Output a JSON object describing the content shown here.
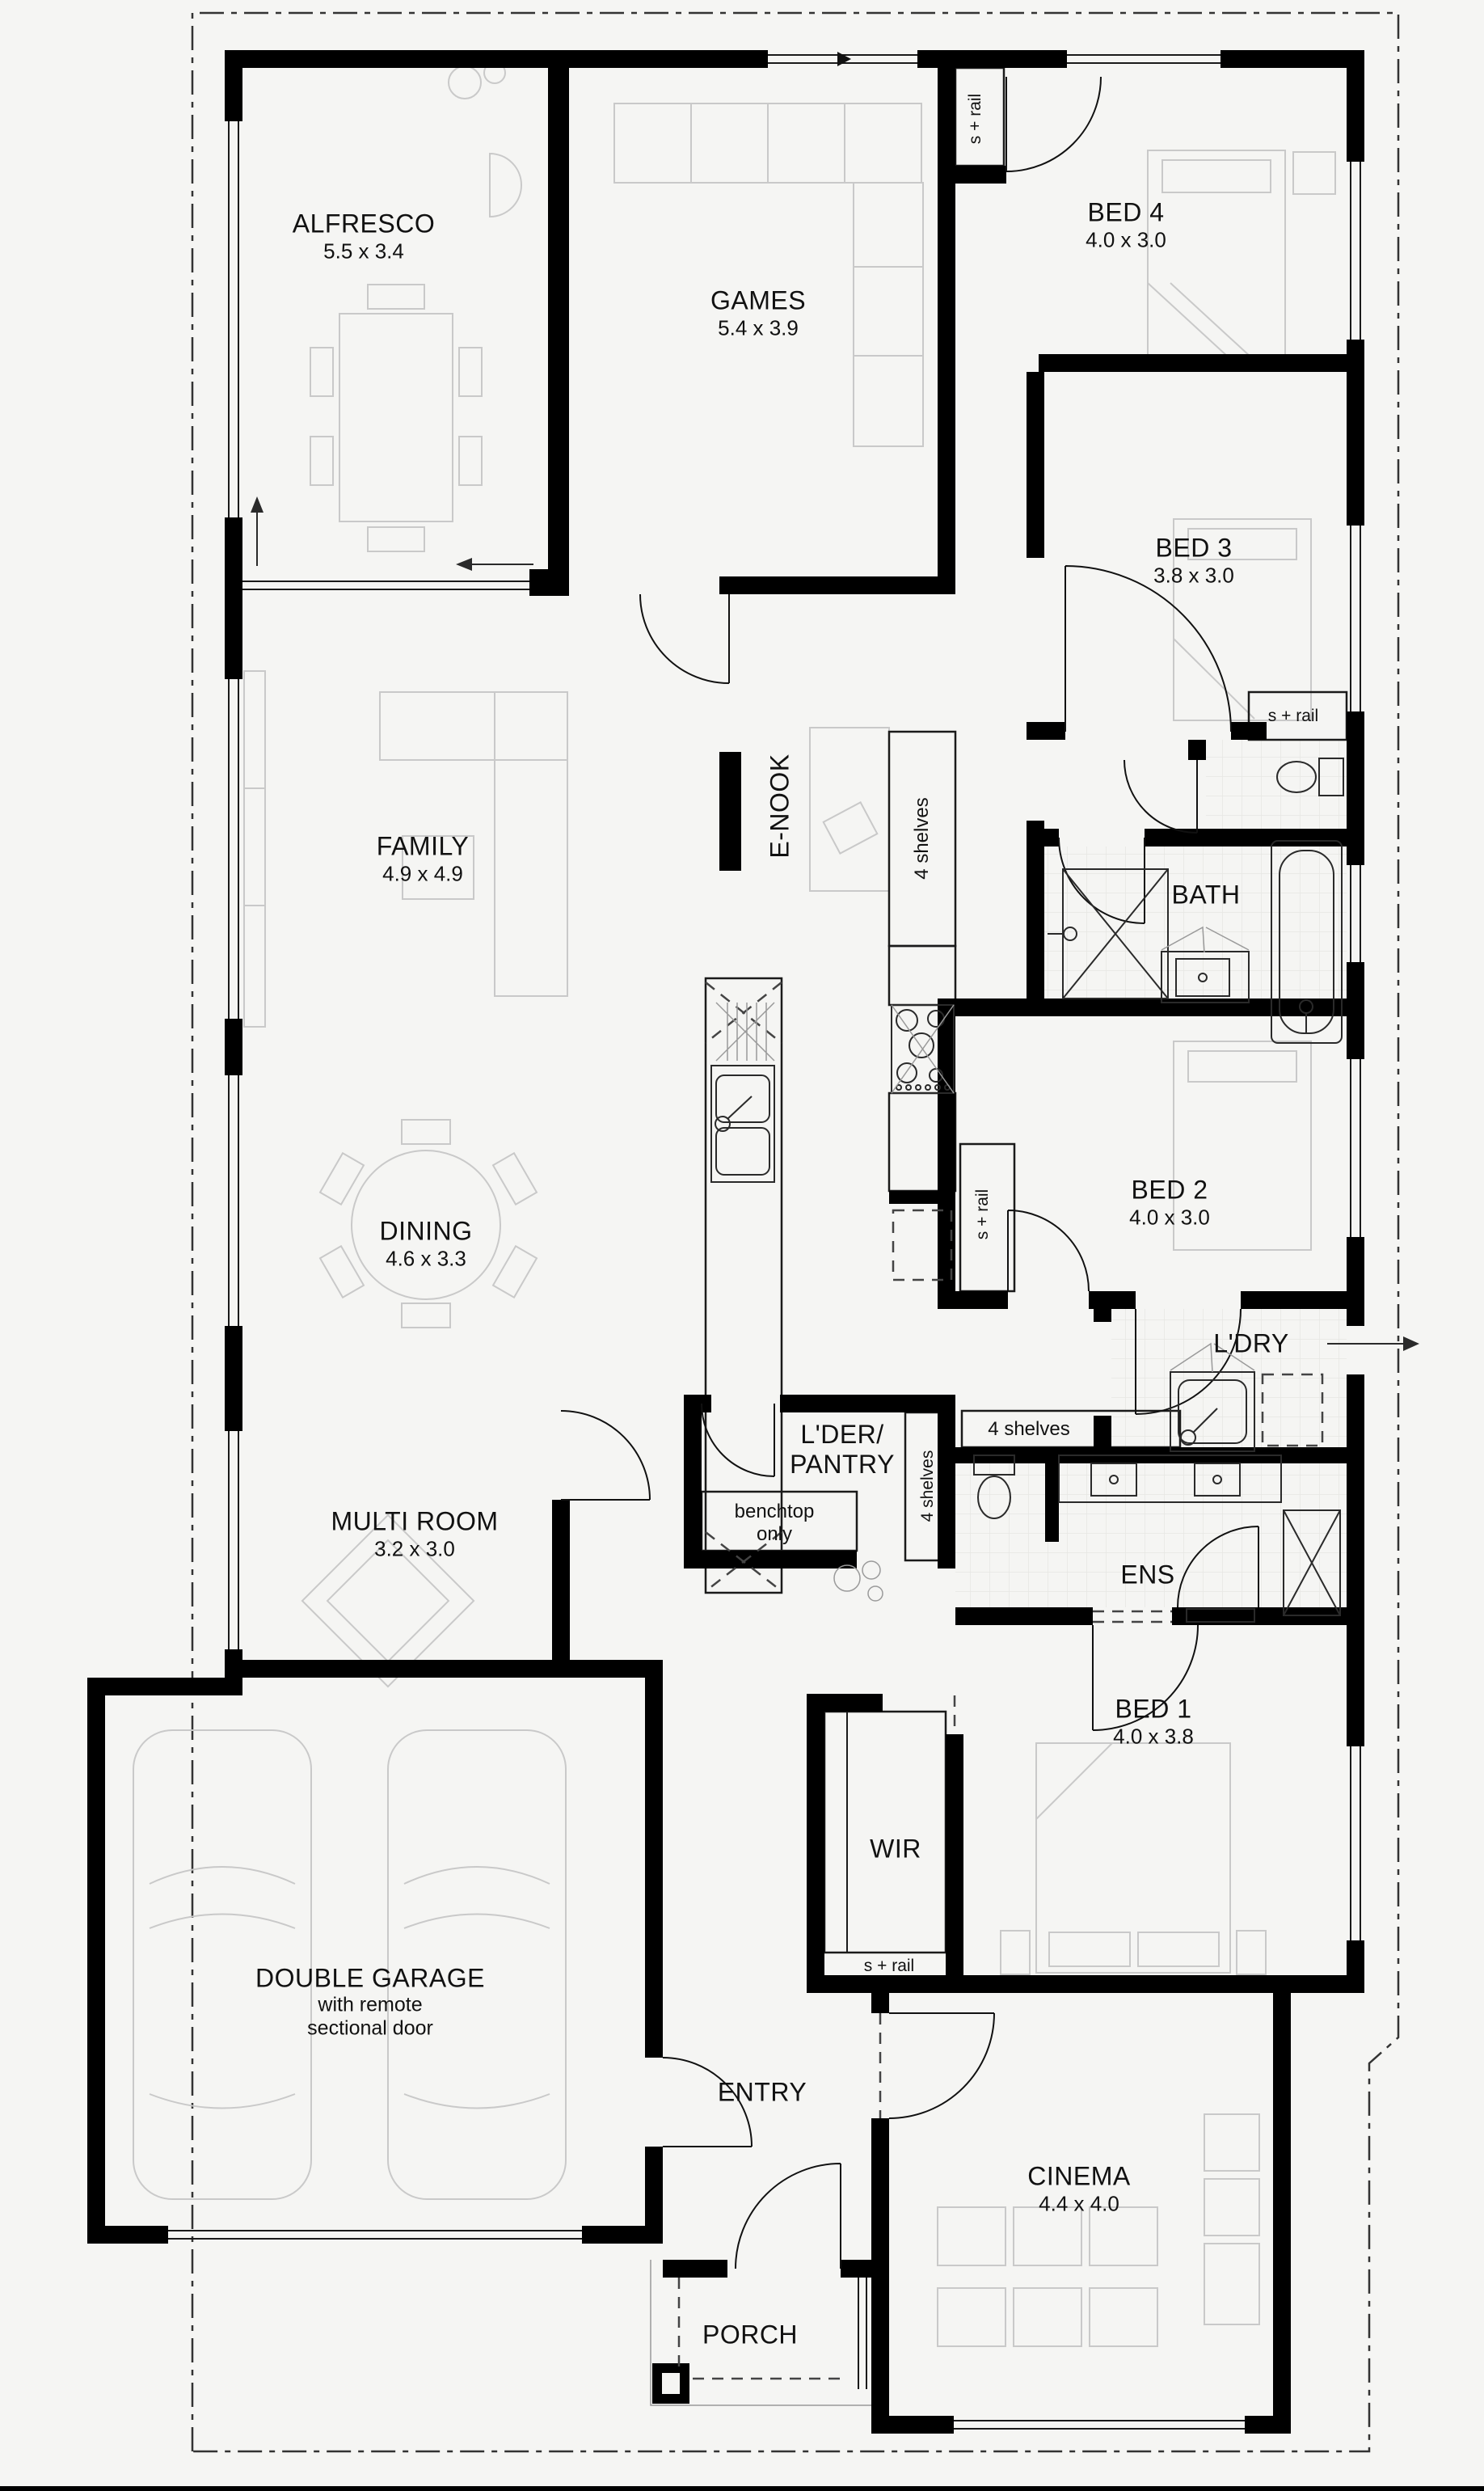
{
  "colors": {
    "background": "#f5f5f3",
    "wall": "#000000",
    "furniture_line": "#c9c9c9",
    "fixture_line": "#2a2a2a",
    "boundary_line": "#333333"
  },
  "rooms": {
    "alfresco": {
      "name": "ALFRESCO",
      "dims": "5.5 x 3.4"
    },
    "games": {
      "name": "GAMES",
      "dims": "5.4 x 3.9"
    },
    "bed4": {
      "name": "BED 4",
      "dims": "4.0 x 3.0"
    },
    "bed3": {
      "name": "BED 3",
      "dims": "3.8 x 3.0"
    },
    "family": {
      "name": "FAMILY",
      "dims": "4.9 x 4.9"
    },
    "enook": {
      "name": "E-NOOK"
    },
    "bath": {
      "name": "BATH"
    },
    "dining": {
      "name": "DINING",
      "dims": "4.6 x 3.3"
    },
    "bed2": {
      "name": "BED 2",
      "dims": "4.0 x 3.0"
    },
    "ldry": {
      "name": "L'DRY"
    },
    "multi": {
      "name": "MULTI ROOM",
      "dims": "3.2 x 3.0"
    },
    "pantry": {
      "line1": "L'DER/",
      "line2": "PANTRY"
    },
    "ens": {
      "name": "ENS"
    },
    "bed1": {
      "name": "BED 1",
      "dims": "4.0 x 3.8"
    },
    "garage": {
      "name": "DOUBLE GARAGE",
      "note1": "with remote",
      "note2": "sectional door"
    },
    "wir": {
      "name": "WIR"
    },
    "entry": {
      "name": "ENTRY"
    },
    "cinema": {
      "name": "CINEMA",
      "dims": "4.4 x 4.0"
    },
    "porch": {
      "name": "PORCH"
    }
  },
  "annotations": {
    "bed4_robe": "s + rail",
    "bed3_robe": "s + rail",
    "bed2_robe": "s + rail",
    "wir_rail": "s + rail",
    "hall_shelves": "4 shelves",
    "pantry_shelves": "4 shelves",
    "linen_shelves": "4 shelves",
    "bench_line1": "benchtop",
    "bench_line2": "only"
  }
}
